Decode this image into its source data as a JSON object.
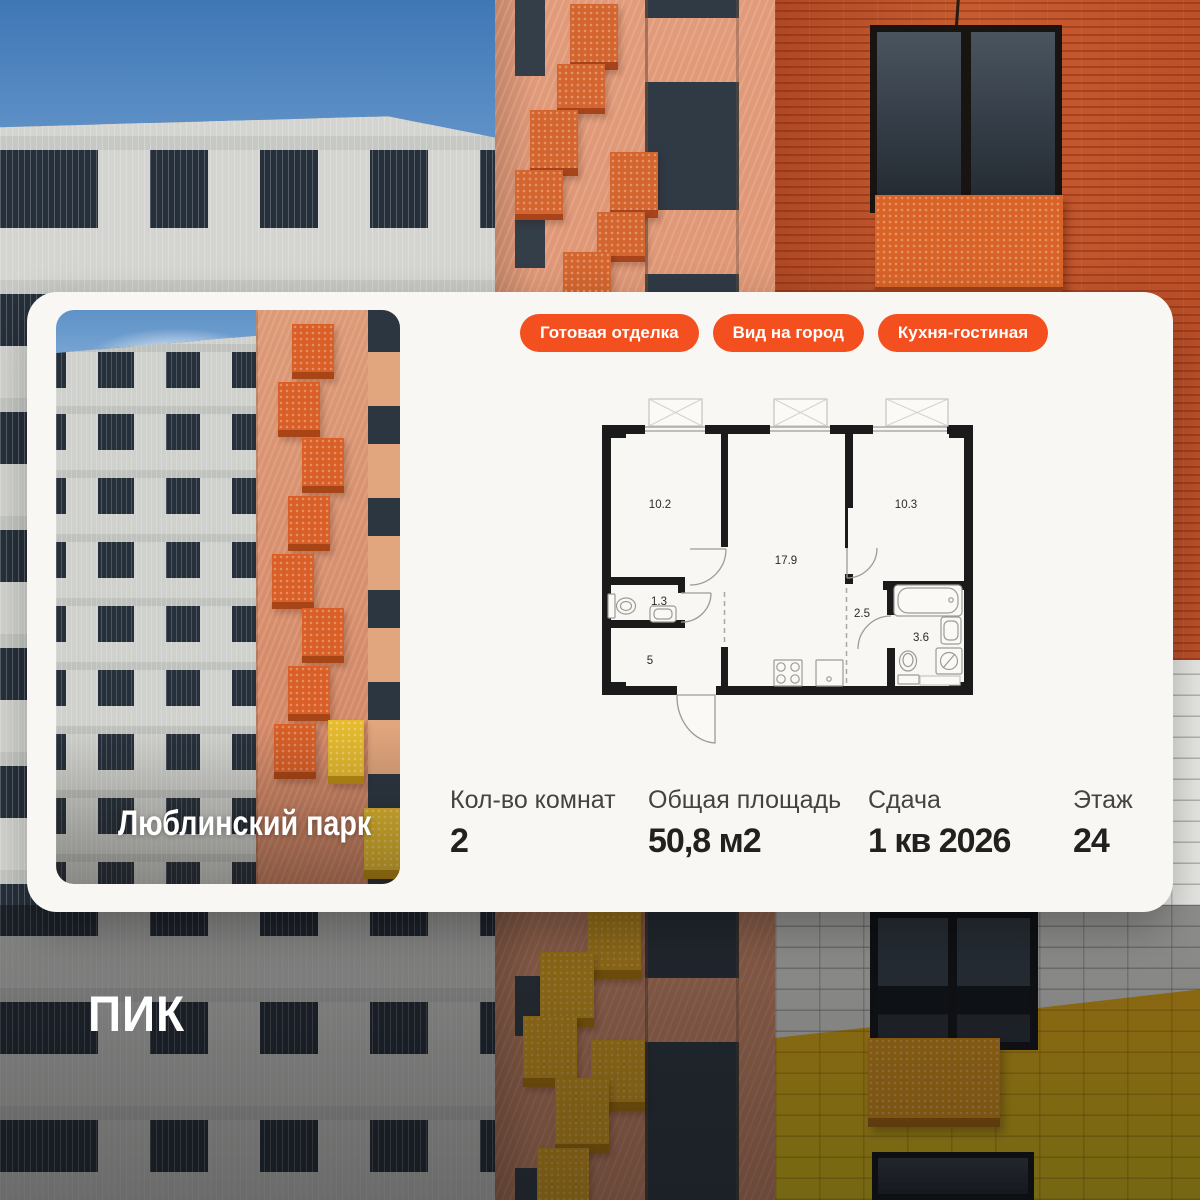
{
  "brand": {
    "logo_text": "ПИК"
  },
  "listing": {
    "project_name": "Люблинский парк",
    "badges": [
      "Готовая отделка",
      "Вид на город",
      "Кухня-гостиная"
    ],
    "stats": [
      {
        "label": "Кол-во комнат",
        "value": "2"
      },
      {
        "label": "Общая площадь",
        "value": "50,8 м2"
      },
      {
        "label": "Сдача",
        "value": "1 кв 2026"
      },
      {
        "label": "Этаж",
        "value": "24"
      }
    ],
    "floorplan": {
      "room_areas": {
        "room1": "10.2",
        "living": "17.9",
        "room2": "10.3",
        "wc": "1.3",
        "hall": "5",
        "corridor": "2.5",
        "bath": "3.6"
      }
    },
    "accent_color": "#F4501F"
  }
}
